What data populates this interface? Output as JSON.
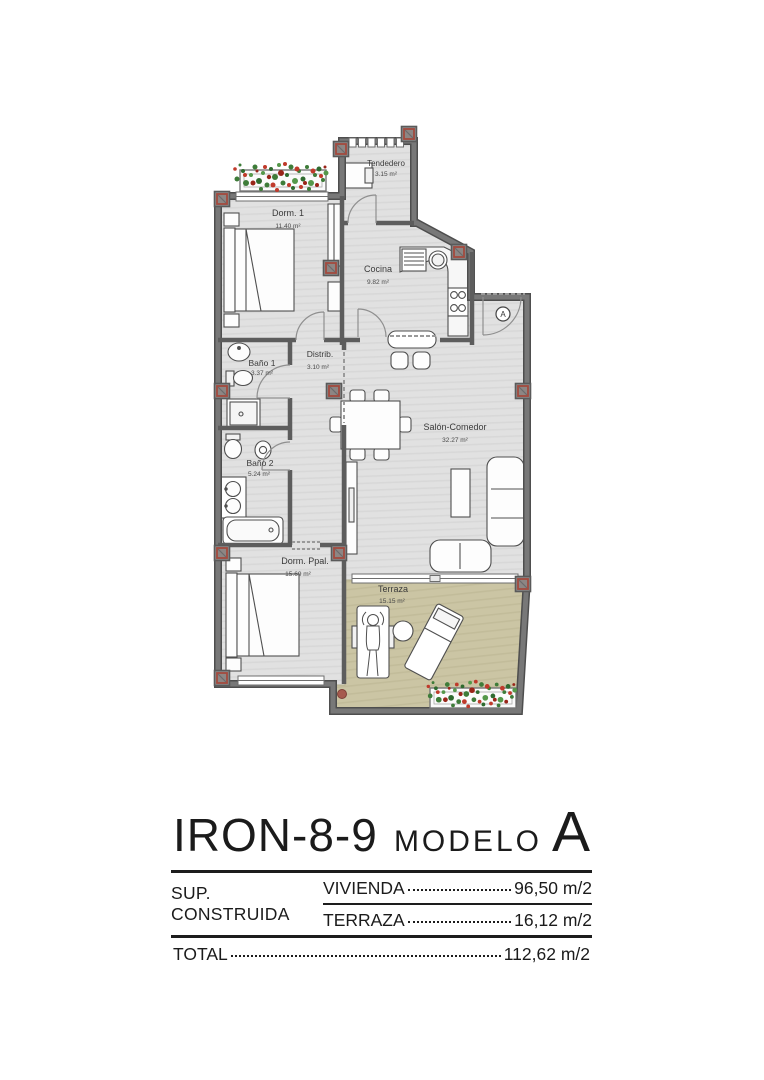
{
  "plan": {
    "entrance_label": "A",
    "rooms": [
      {
        "id": "tendedero",
        "name": "Tendedero",
        "area": "3.15 m²"
      },
      {
        "id": "dorm1",
        "name": "Dorm. 1",
        "area": "11.40 m²"
      },
      {
        "id": "cocina",
        "name": "Cocina",
        "area": "9.82 m²"
      },
      {
        "id": "distrib",
        "name": "Distrib.",
        "area": "3.10 m²"
      },
      {
        "id": "bano1",
        "name": "Baño 1",
        "area": "3.37 m²"
      },
      {
        "id": "bano2",
        "name": "Baño 2",
        "area": "5.24 m²"
      },
      {
        "id": "salon",
        "name": "Salón-Comedor",
        "area": "32.27 m²"
      },
      {
        "id": "dorm_ppal",
        "name": "Dorm. Ppal.",
        "area": "15.69 m²"
      },
      {
        "id": "terraza",
        "name": "Terraza",
        "area": "15.15 m²"
      }
    ],
    "colors": {
      "wall": "#6a6a6a",
      "wall_outline": "#4e4e4e",
      "floor": "#e1e1e1",
      "terrace_floor": "#cbc5a4",
      "pillar_red": "#a34a3e",
      "plant_green": "#3e7c39",
      "plant_red": "#c03a2b"
    }
  },
  "title_block": {
    "model_code": "IRON-8-9",
    "model_label": "MODELO",
    "model_letter": "A",
    "surface_label": "SUP. CONSTRUIDA",
    "rows": [
      {
        "label": "VIVIENDA",
        "value": "96,50 m/2"
      },
      {
        "label": "TERRAZA",
        "value": "16,12 m/2"
      }
    ],
    "total": {
      "label": "TOTAL",
      "value": "112,62 m/2"
    }
  }
}
